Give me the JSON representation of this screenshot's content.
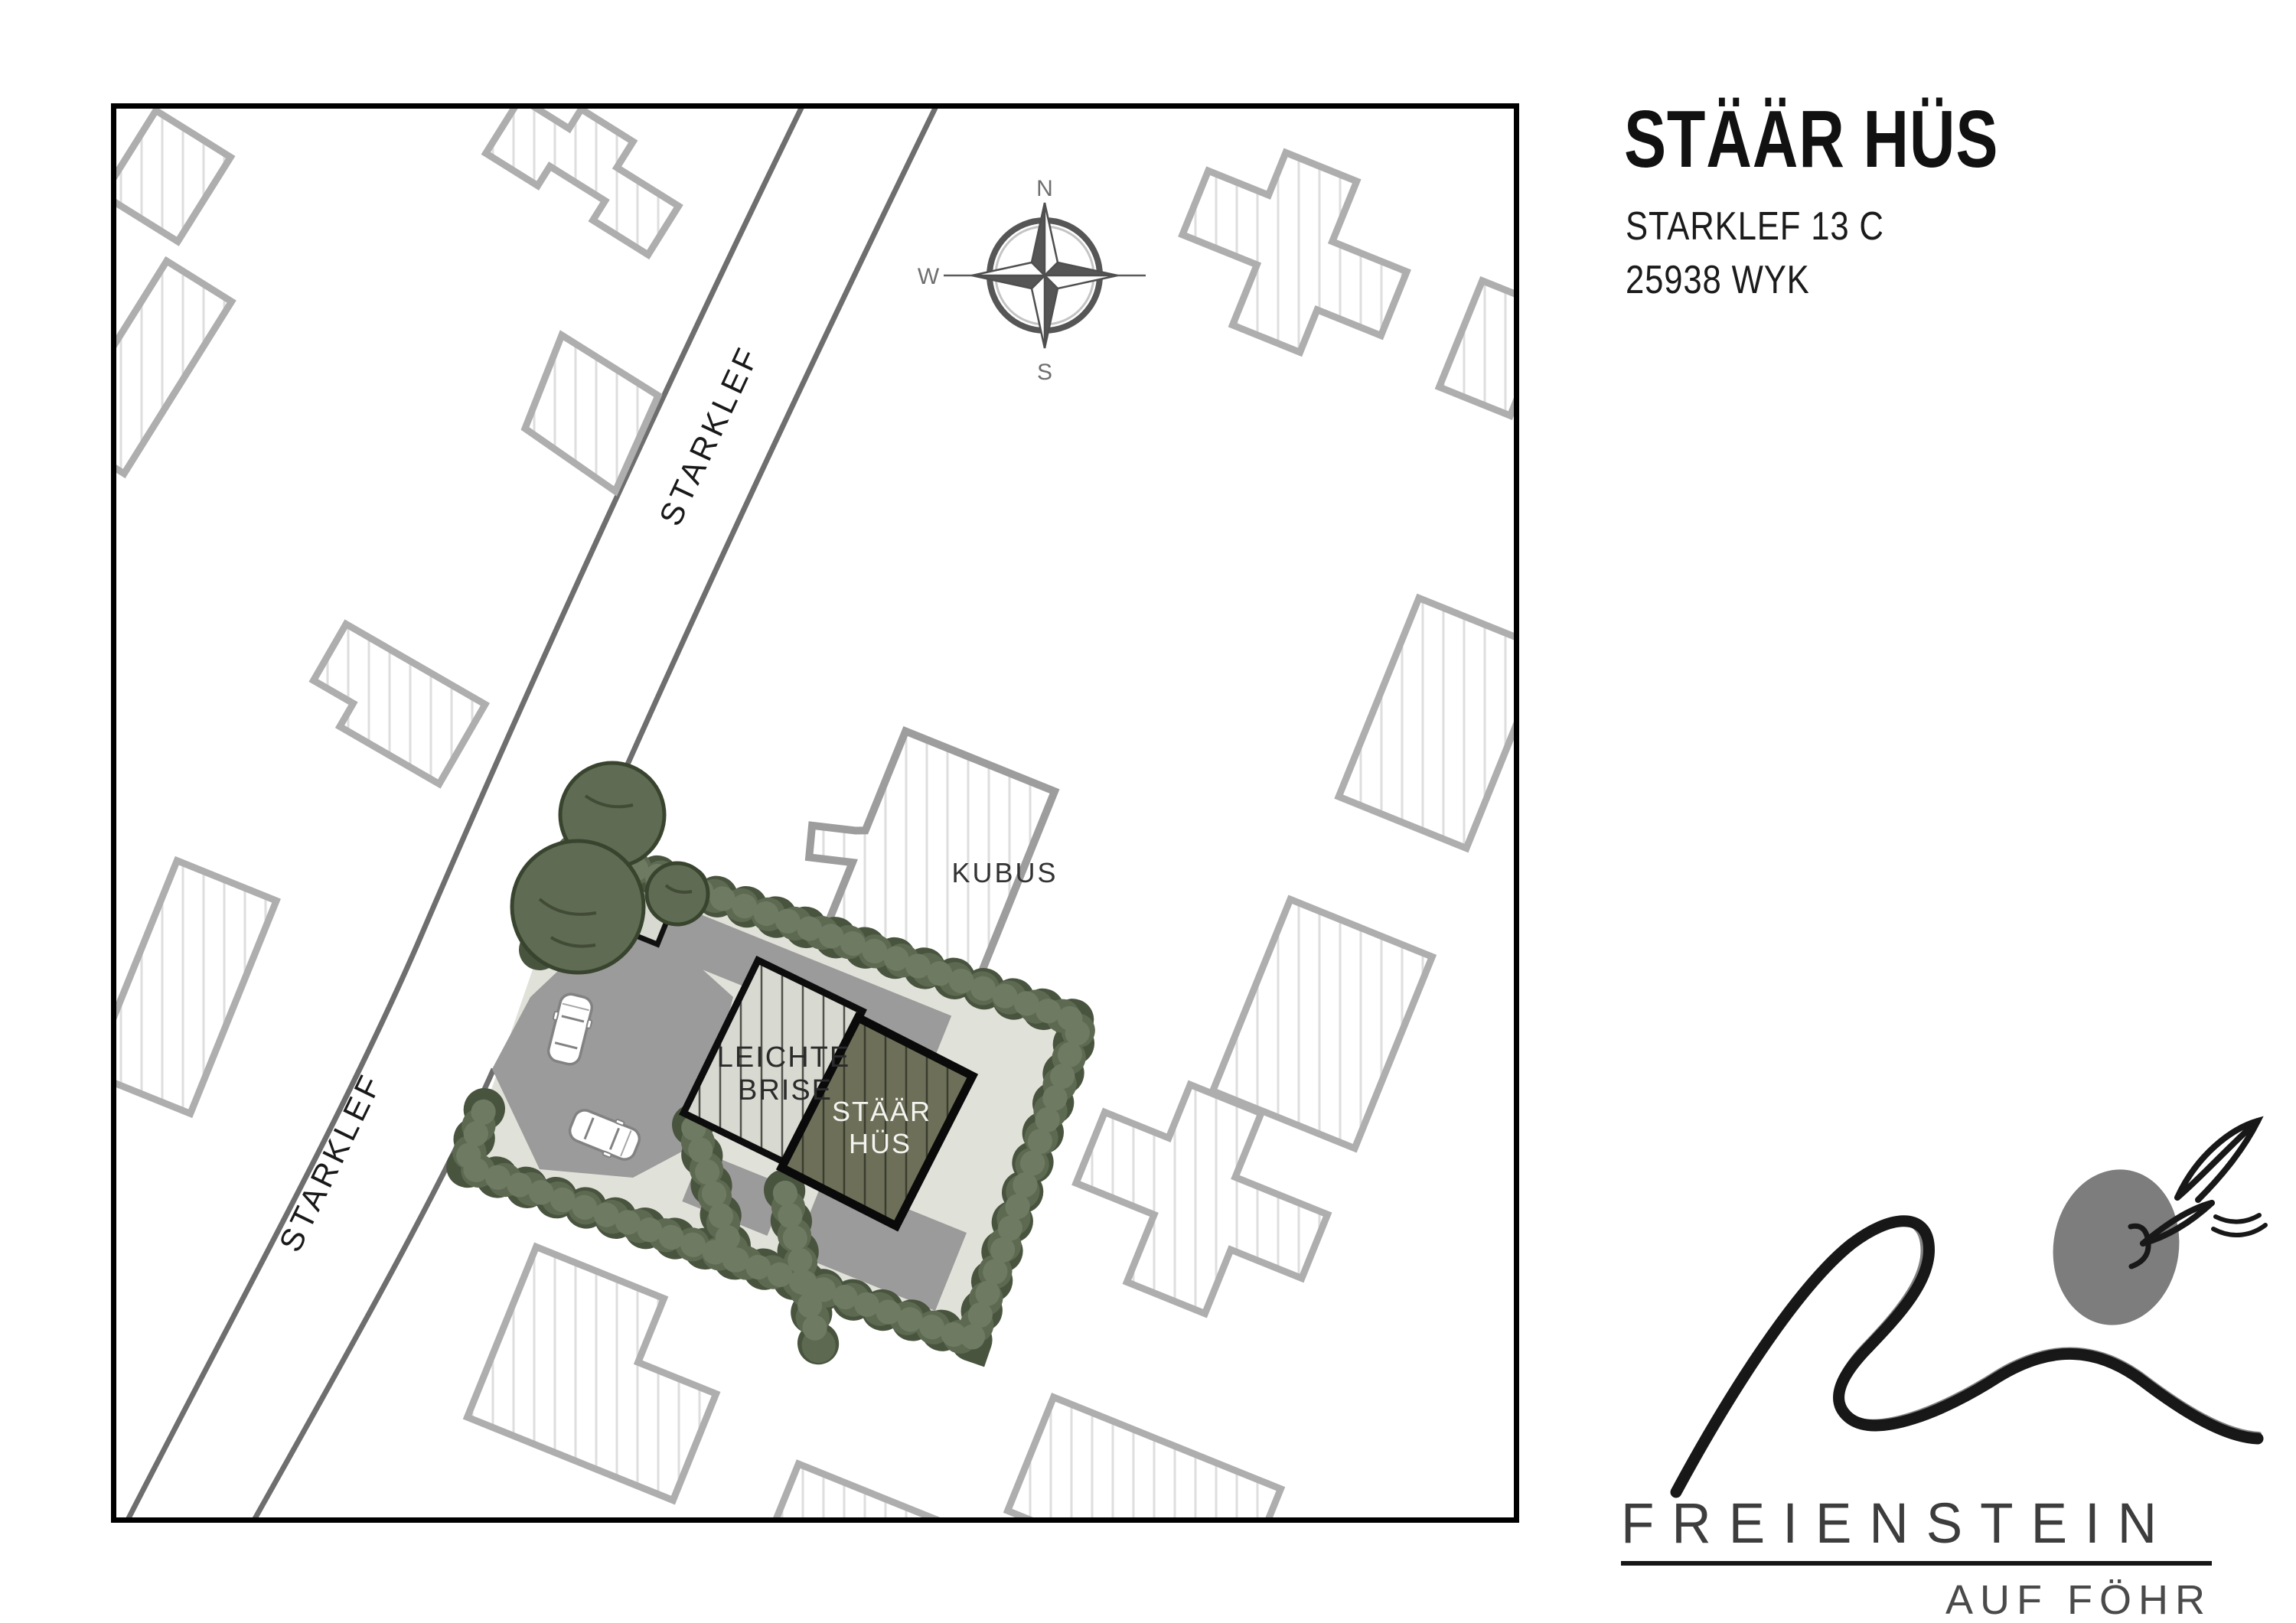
{
  "header": {
    "title": "STÄÄR HÜS",
    "address1": "STARKLEF 13 C",
    "address2": "25938 WYK"
  },
  "map": {
    "street_label": "STARKLEF",
    "compass": {
      "n": "N",
      "e": "O",
      "s": "S",
      "w": "W"
    },
    "labels": {
      "kubus": "KUBUS",
      "brise1": "LEICHTE",
      "brise2": "BRISE",
      "staar1": "STÄÄR",
      "staar2": "HÜS"
    }
  },
  "logo": {
    "name": "FREIENSTEIN",
    "tagline": "AUF FÖHR"
  },
  "colors": {
    "site_fill": "#e0e2d9",
    "driveway": "#9b9b9b",
    "hedge_dark": "#49543f",
    "hedge_mid": "#5d6950",
    "hedge_light": "#6e7a61",
    "tree_fill": "#5f6b52",
    "tree_stroke": "#39442f",
    "leichte_brise_fill": "#d8d9d1",
    "staar_hus_fill": "#6d6f58",
    "building_outline": "#0d0d0d",
    "neighbor_stroke": "#aeaeae",
    "road_line": "#6e6e6e",
    "logo_blob": "#7d7d7d"
  }
}
